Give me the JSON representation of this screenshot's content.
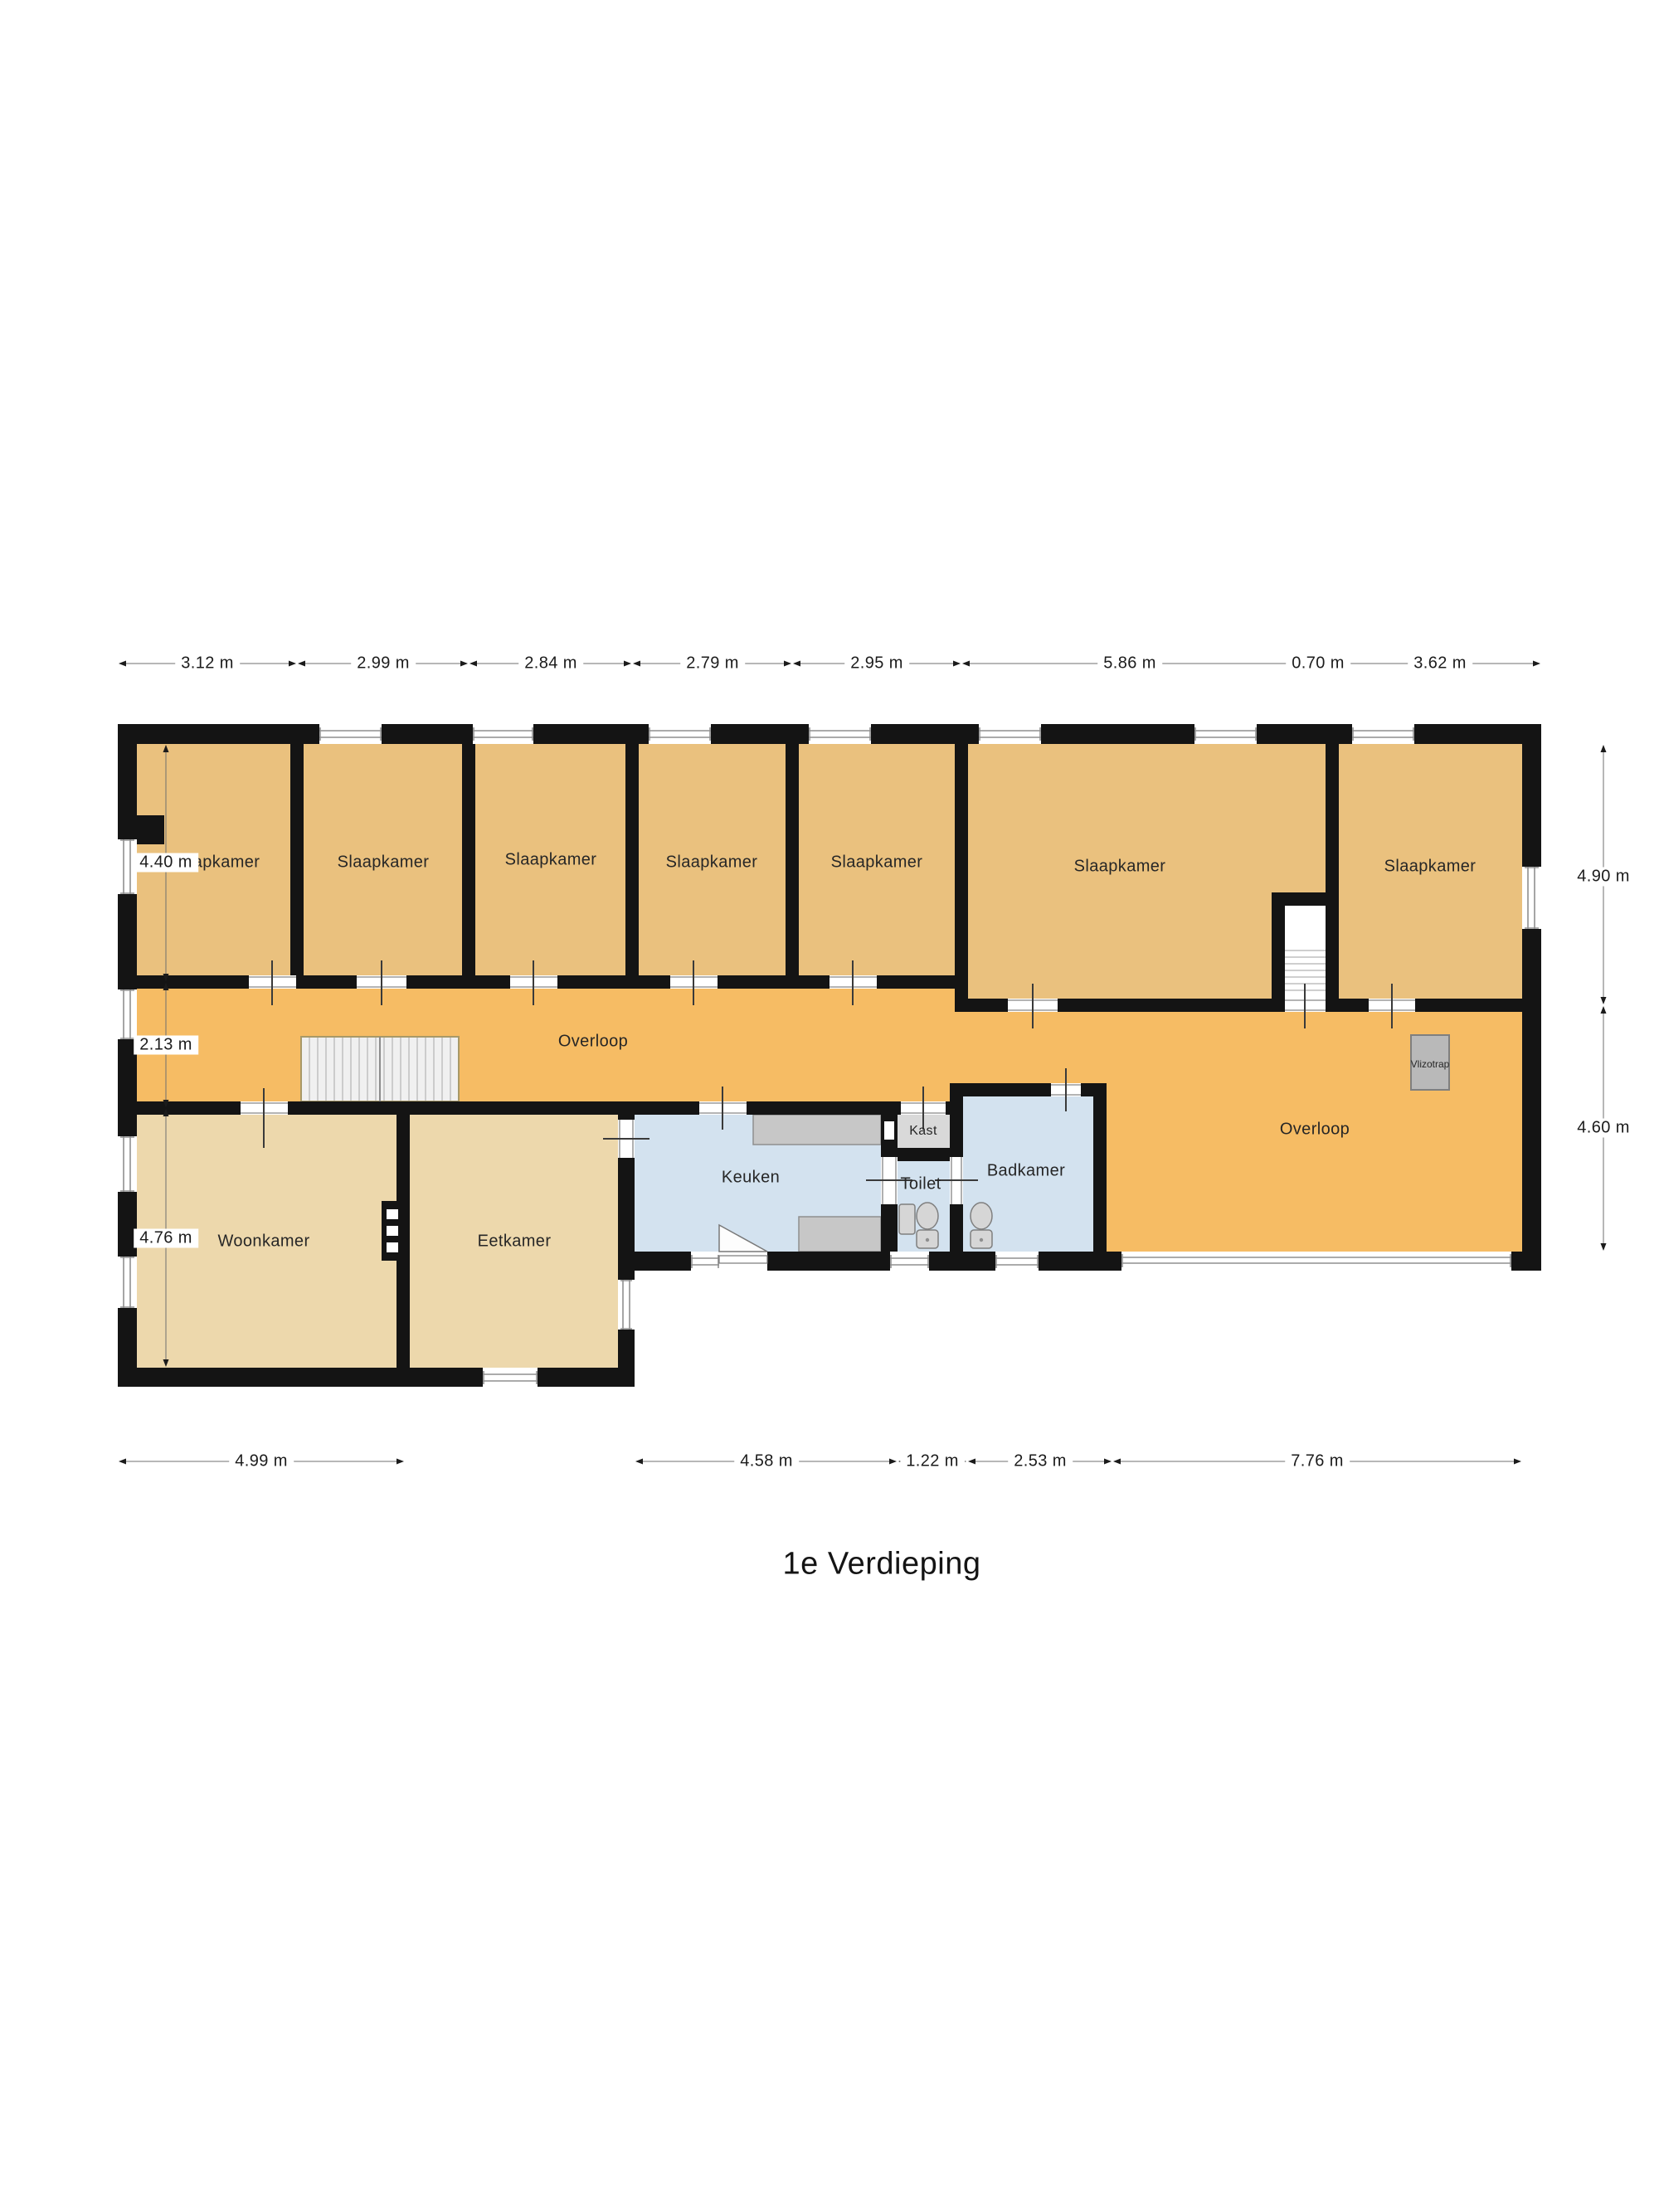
{
  "title": "1e Verdieping",
  "floorplan": {
    "room_labels": [
      {
        "id": "slaapkamer-1",
        "label": "Slaapkamer"
      },
      {
        "id": "slaapkamer-2",
        "label": "Slaapkamer"
      },
      {
        "id": "slaapkamer-3",
        "label": "Slaapkamer"
      },
      {
        "id": "slaapkamer-4",
        "label": "Slaapkamer"
      },
      {
        "id": "slaapkamer-5",
        "label": "Slaapkamer"
      },
      {
        "id": "slaapkamer-6",
        "label": "Slaapkamer"
      },
      {
        "id": "slaapkamer-7",
        "label": "Slaapkamer"
      },
      {
        "id": "overloop-left",
        "label": "Overloop"
      },
      {
        "id": "overloop-right",
        "label": "Overloop"
      },
      {
        "id": "woonkamer",
        "label": "Woonkamer"
      },
      {
        "id": "eetkamer",
        "label": "Eetkamer"
      },
      {
        "id": "keuken",
        "label": "Keuken"
      },
      {
        "id": "kast",
        "label": "Kast"
      },
      {
        "id": "toilet",
        "label": "Toilet"
      },
      {
        "id": "badkamer",
        "label": "Badkamer"
      },
      {
        "id": "vlizotrap",
        "label": "Vlizotrap"
      }
    ],
    "dimensions": {
      "top": [
        "3.12 m",
        "2.99 m",
        "2.84 m",
        "2.79 m",
        "2.95 m",
        "5.86 m",
        "0.70 m",
        "3.62 m"
      ],
      "left": [
        "4.40 m",
        "2.13 m",
        "4.76 m"
      ],
      "right": [
        "4.90 m",
        "4.60 m"
      ],
      "bottom": [
        "4.99 m",
        "4.58 m",
        "1.22 m",
        "2.53 m",
        "7.76 m"
      ]
    },
    "colors": {
      "bedroom_fill": "#EAC17E",
      "hallway_fill": "#F6BC64",
      "living_fill": "#EDD8AC",
      "wet_room_fill": "#D3E2EF",
      "closet_fill": "#D9D9D9",
      "wall": "#141414"
    }
  }
}
